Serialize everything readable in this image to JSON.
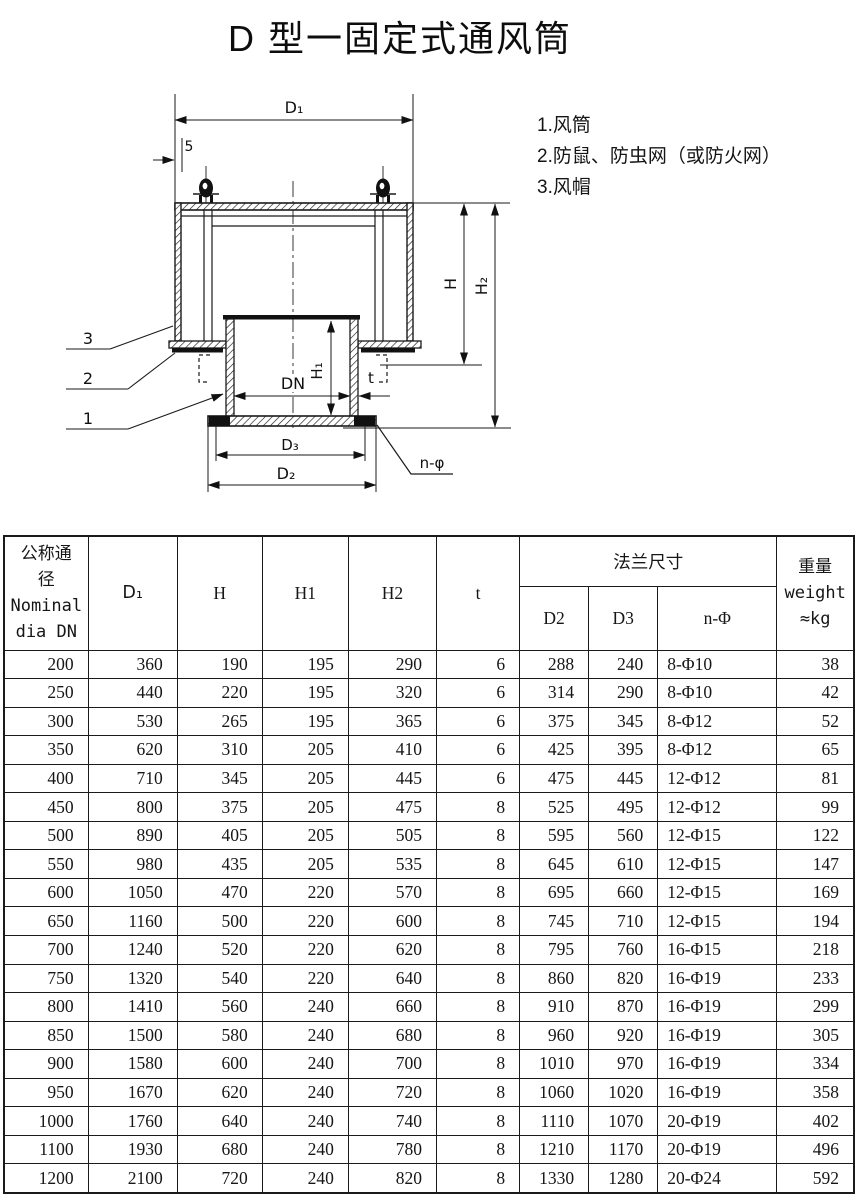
{
  "title": "D 型一固定式通风筒",
  "legend": {
    "items": [
      "1.风筒",
      "2.防鼠、防虫网（或防火网）",
      "3.风帽"
    ]
  },
  "drawing": {
    "dim_d1": "D₁",
    "dim_5": "5",
    "dim_h": "H",
    "dim_h2": "H₂",
    "dim_h1": "H₁",
    "dim_dn": "DN",
    "dim_t": "t",
    "dim_d3": "D₃",
    "dim_d2": "D₂",
    "dim_nphi": "n-φ",
    "callout_3": "3",
    "callout_2": "2",
    "callout_1": "1"
  },
  "table": {
    "header": {
      "dn_lines": [
        "公称通",
        "径",
        "Nominal",
        "dia DN"
      ],
      "d1": "D₁",
      "h": "H",
      "h1": "H1",
      "h2": "H2",
      "t": "t",
      "flange_group": "法兰尺寸",
      "d2": "D2",
      "d3": "D3",
      "n_phi": "n-Φ",
      "weight_lines": [
        "重量",
        "weight",
        "≈kg"
      ]
    },
    "rows": [
      [
        200,
        360,
        190,
        195,
        290,
        6,
        288,
        240,
        "8-Φ10",
        38
      ],
      [
        250,
        440,
        220,
        195,
        320,
        6,
        314,
        290,
        "8-Φ10",
        42
      ],
      [
        300,
        530,
        265,
        195,
        365,
        6,
        375,
        345,
        "8-Φ12",
        52
      ],
      [
        350,
        620,
        310,
        205,
        410,
        6,
        425,
        395,
        "8-Φ12",
        65
      ],
      [
        400,
        710,
        345,
        205,
        445,
        6,
        475,
        445,
        "12-Φ12",
        81
      ],
      [
        450,
        800,
        375,
        205,
        475,
        8,
        525,
        495,
        "12-Φ12",
        99
      ],
      [
        500,
        890,
        405,
        205,
        505,
        8,
        595,
        560,
        "12-Φ15",
        122
      ],
      [
        550,
        980,
        435,
        205,
        535,
        8,
        645,
        610,
        "12-Φ15",
        147
      ],
      [
        600,
        1050,
        470,
        220,
        570,
        8,
        695,
        660,
        "12-Φ15",
        169
      ],
      [
        650,
        1160,
        500,
        220,
        600,
        8,
        745,
        710,
        "12-Φ15",
        194
      ],
      [
        700,
        1240,
        520,
        220,
        620,
        8,
        795,
        760,
        "16-Φ15",
        218
      ],
      [
        750,
        1320,
        540,
        220,
        640,
        8,
        860,
        820,
        "16-Φ19",
        233
      ],
      [
        800,
        1410,
        560,
        240,
        660,
        8,
        910,
        870,
        "16-Φ19",
        299
      ],
      [
        850,
        1500,
        580,
        240,
        680,
        8,
        960,
        920,
        "16-Φ19",
        305
      ],
      [
        900,
        1580,
        600,
        240,
        700,
        8,
        1010,
        970,
        "16-Φ19",
        334
      ],
      [
        950,
        1670,
        620,
        240,
        720,
        8,
        1060,
        1020,
        "16-Φ19",
        358
      ],
      [
        1000,
        1760,
        640,
        240,
        740,
        8,
        1110,
        1070,
        "20-Φ19",
        402
      ],
      [
        1100,
        1930,
        680,
        240,
        780,
        8,
        1210,
        1170,
        "20-Φ19",
        496
      ],
      [
        1200,
        2100,
        720,
        240,
        820,
        8,
        1330,
        1280,
        "20-Φ24",
        592
      ]
    ]
  }
}
